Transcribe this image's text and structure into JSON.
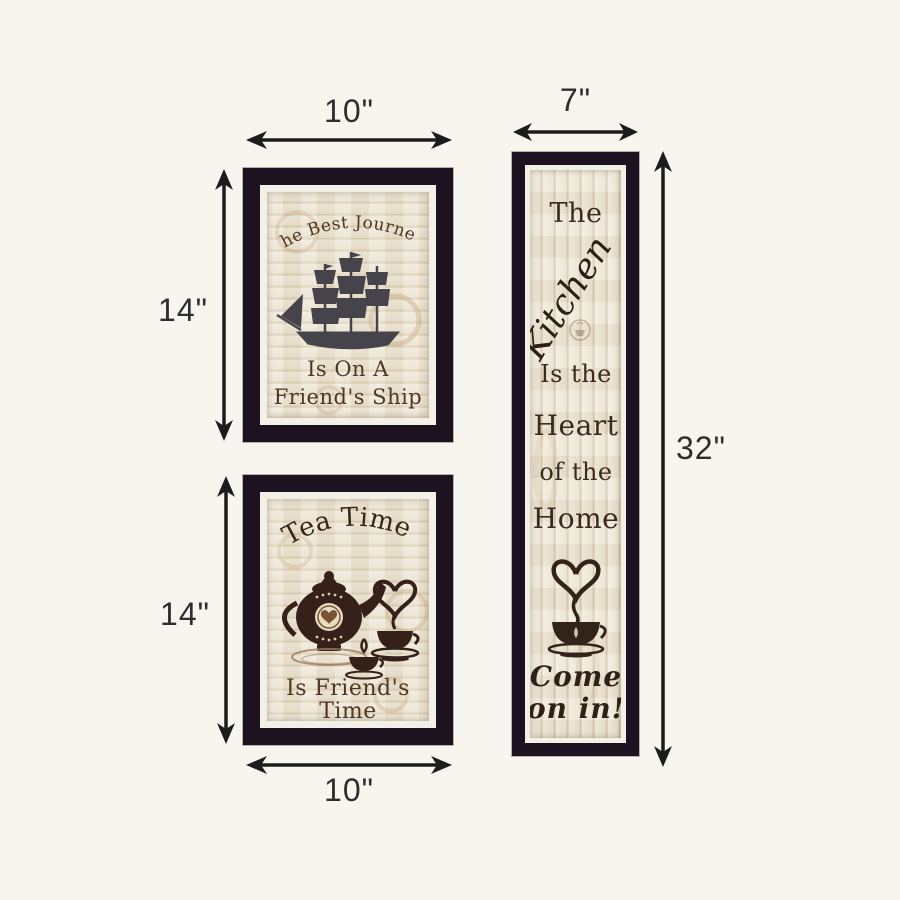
{
  "diagram": {
    "dim_labels": {
      "journey_width": "10\"",
      "journey_height": "14\"",
      "tea_width": "10\"",
      "tea_height": "14\"",
      "kitchen_width": "7\"",
      "kitchen_height": "32\""
    },
    "prints": {
      "journey": {
        "arc": "The Best Journey",
        "line2": "Is On A",
        "line3": "Friend's Ship"
      },
      "tea": {
        "arc": "Tea Time",
        "line2": "Is Friend's",
        "line3": "Time"
      },
      "kitchen": {
        "word1": "The",
        "word2": "Kitchen",
        "line3": "Is the",
        "line4": "Heart",
        "line5": "of the",
        "line6": "Home",
        "line7": "Come",
        "line8": "on in!"
      }
    },
    "colors": {
      "background": "#f7f5ee",
      "frame": "#1c1220",
      "mat": "#f2efe7",
      "wood_light": "#f0e9da",
      "wood_dark": "#d7cab0",
      "text_brown": "#503724",
      "silhouette_brown": "#35211a",
      "ship_gray": "#46444a",
      "stain_tan": "#b98f5e",
      "arrow_black": "#1c1c1c"
    }
  }
}
